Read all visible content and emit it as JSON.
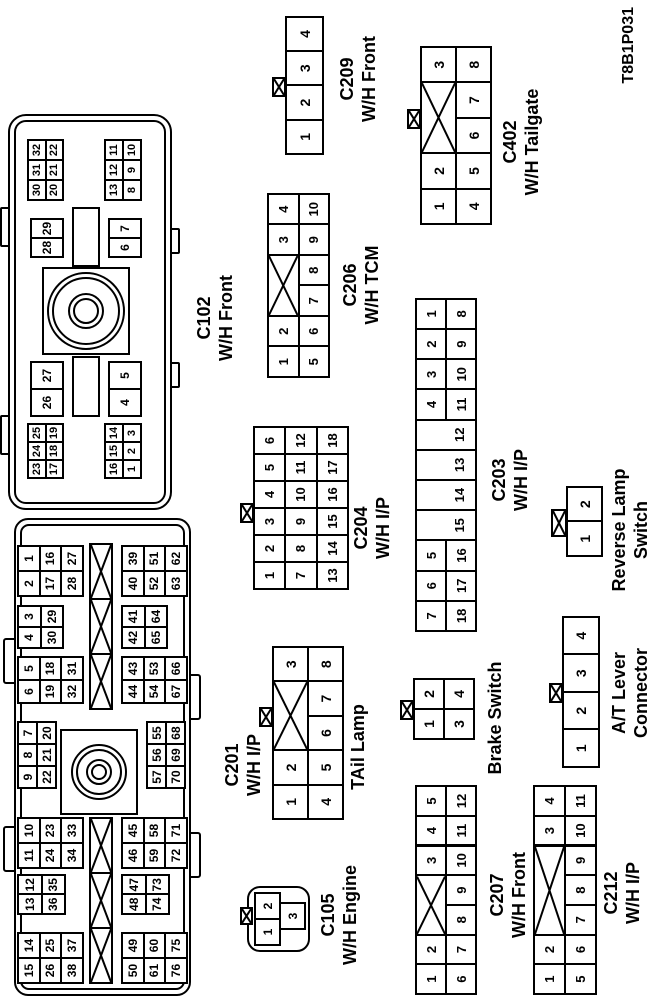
{
  "page": {
    "diagram_code": "T8B1P031"
  },
  "colors": {
    "line": "#000000",
    "background": "#ffffff",
    "text": "#000000"
  },
  "connectors": {
    "c201": {
      "name": "C201",
      "system": "W/H I/P",
      "top_groups": [
        [
          [
            "15",
            "14"
          ],
          [
            "26",
            "25"
          ],
          [
            "38",
            "37"
          ]
        ],
        [
          [
            "13",
            "12"
          ],
          [
            "36",
            "35"
          ]
        ],
        [
          [
            "11",
            "10"
          ],
          [
            "24",
            "23"
          ],
          [
            "34",
            "33"
          ]
        ],
        [
          [
            "9",
            "8",
            "7"
          ],
          [
            "22",
            "21",
            "20"
          ]
        ],
        [
          [
            "6",
            "5"
          ],
          [
            "19",
            "18"
          ],
          [
            "32",
            "31"
          ]
        ],
        [
          [
            "4",
            "3"
          ],
          [
            "30",
            "29"
          ]
        ],
        [
          [
            "2",
            "1"
          ],
          [
            "17",
            "16"
          ],
          [
            "28",
            "27"
          ]
        ]
      ],
      "bottom_groups": [
        [
          [
            "50",
            "49"
          ],
          [
            "61",
            "60"
          ],
          [
            "76",
            "75"
          ]
        ],
        [
          [
            "48",
            "47"
          ],
          [
            "74",
            "73"
          ]
        ],
        [
          [
            "46",
            "45"
          ],
          [
            "59",
            "58"
          ],
          [
            "72",
            "71"
          ]
        ],
        [
          [
            "57",
            "56",
            "55"
          ],
          [
            "70",
            "69",
            "68"
          ]
        ],
        [
          [
            "44",
            "43"
          ],
          [
            "54",
            "53"
          ],
          [
            "67",
            "66"
          ]
        ],
        [
          [
            "42",
            "41"
          ],
          [
            "65",
            "64"
          ]
        ],
        [
          [
            "40",
            "39"
          ],
          [
            "52",
            "51"
          ],
          [
            "63",
            "62"
          ]
        ]
      ]
    },
    "c102": {
      "name": "C102",
      "system": "W/H Front",
      "top_left": [
        [
          "23",
          "24",
          "25"
        ],
        [
          "17",
          "18",
          "19"
        ]
      ],
      "top_pair_left": [
        "26",
        "27"
      ],
      "top_pair_right": [
        "28",
        "29"
      ],
      "top_right": [
        [
          "30",
          "31",
          "32"
        ],
        [
          "20",
          "21",
          "22"
        ]
      ],
      "bottom_left": [
        [
          "16",
          "15",
          "14"
        ],
        [
          "1",
          "2",
          "3"
        ]
      ],
      "bottom_pair_left": [
        "4",
        "5"
      ],
      "bottom_pair_right": [
        "6",
        "7"
      ],
      "bottom_right": [
        [
          "13",
          "12",
          "11"
        ],
        [
          "8",
          "9",
          "10"
        ]
      ]
    },
    "c209": {
      "name": "C209",
      "system": "W/H Front",
      "pins": [
        "1",
        "2",
        "3",
        "4"
      ]
    },
    "c206": {
      "name": "C206",
      "system": "W/H TCM",
      "top_row": [
        "1",
        "2",
        "X:2",
        "3",
        "4"
      ],
      "bottom_row": [
        "5",
        "6",
        "7",
        "8",
        "9",
        "10"
      ]
    },
    "c402": {
      "name": "C402",
      "system": "W/H Tailgate",
      "top_row": [
        "1",
        "2",
        "X:2",
        "3"
      ],
      "bottom_row": [
        "4",
        "5",
        "6",
        "7",
        "8"
      ]
    },
    "c204": {
      "name": "C204",
      "system": "W/H I/P",
      "rows": [
        [
          "1",
          "2",
          "3",
          "4",
          "5",
          "6"
        ],
        [
          "7",
          "8",
          "9",
          "10",
          "11",
          "12"
        ],
        [
          "13",
          "14",
          "15",
          "16",
          "17",
          "18"
        ]
      ]
    },
    "c203": {
      "name": "C203",
      "system": "W/H I/P",
      "columns": [
        {
          "top": "7",
          "bottom": "18"
        },
        {
          "top": "6",
          "bottom": "17"
        },
        {
          "top": "5",
          "bottom": "16"
        },
        {
          "full": "15"
        },
        {
          "full": "14"
        },
        {
          "full": "13"
        },
        {
          "full": "12"
        },
        {
          "top": "4",
          "bottom": "11"
        },
        {
          "top": "3",
          "bottom": "10"
        },
        {
          "top": "2",
          "bottom": "9"
        },
        {
          "top": "1",
          "bottom": "8"
        }
      ]
    },
    "tail_lamp": {
      "name": "TAil Lamp",
      "top_row": [
        "1",
        "2",
        "X:2",
        "3"
      ],
      "bottom_row": [
        "4",
        "5",
        "6",
        "7",
        "8"
      ]
    },
    "brake_switch": {
      "name": "Brake Switch",
      "rows": [
        [
          "1",
          "2"
        ],
        [
          "3",
          "4"
        ]
      ]
    },
    "reverse_lamp_switch": {
      "line1": "Reverse Lamp",
      "line2": "Switch",
      "pins": [
        "1",
        "2"
      ]
    },
    "at_lever": {
      "line1": "A/T Lever",
      "line2": "Connector",
      "pins": [
        "1",
        "2",
        "3",
        "4"
      ]
    },
    "c105": {
      "name": "C105",
      "system": "W/H Engine",
      "top_row": [
        "1",
        "2"
      ],
      "bottom_row": [
        "3"
      ]
    },
    "c207": {
      "name": "C207",
      "system": "W/H Front",
      "top_row": [
        "1",
        "2",
        "X:2",
        "3",
        "4",
        "5"
      ],
      "bottom_row": [
        "6",
        "7",
        "8",
        "9",
        "10",
        "11",
        "12"
      ]
    },
    "c212": {
      "name": "C212",
      "system": "W/H I/P",
      "top_row": [
        "1",
        "2",
        "X:3",
        "3",
        "4"
      ],
      "bottom_row": [
        "5",
        "6",
        "7",
        "8",
        "9",
        "10",
        "11"
      ]
    }
  }
}
